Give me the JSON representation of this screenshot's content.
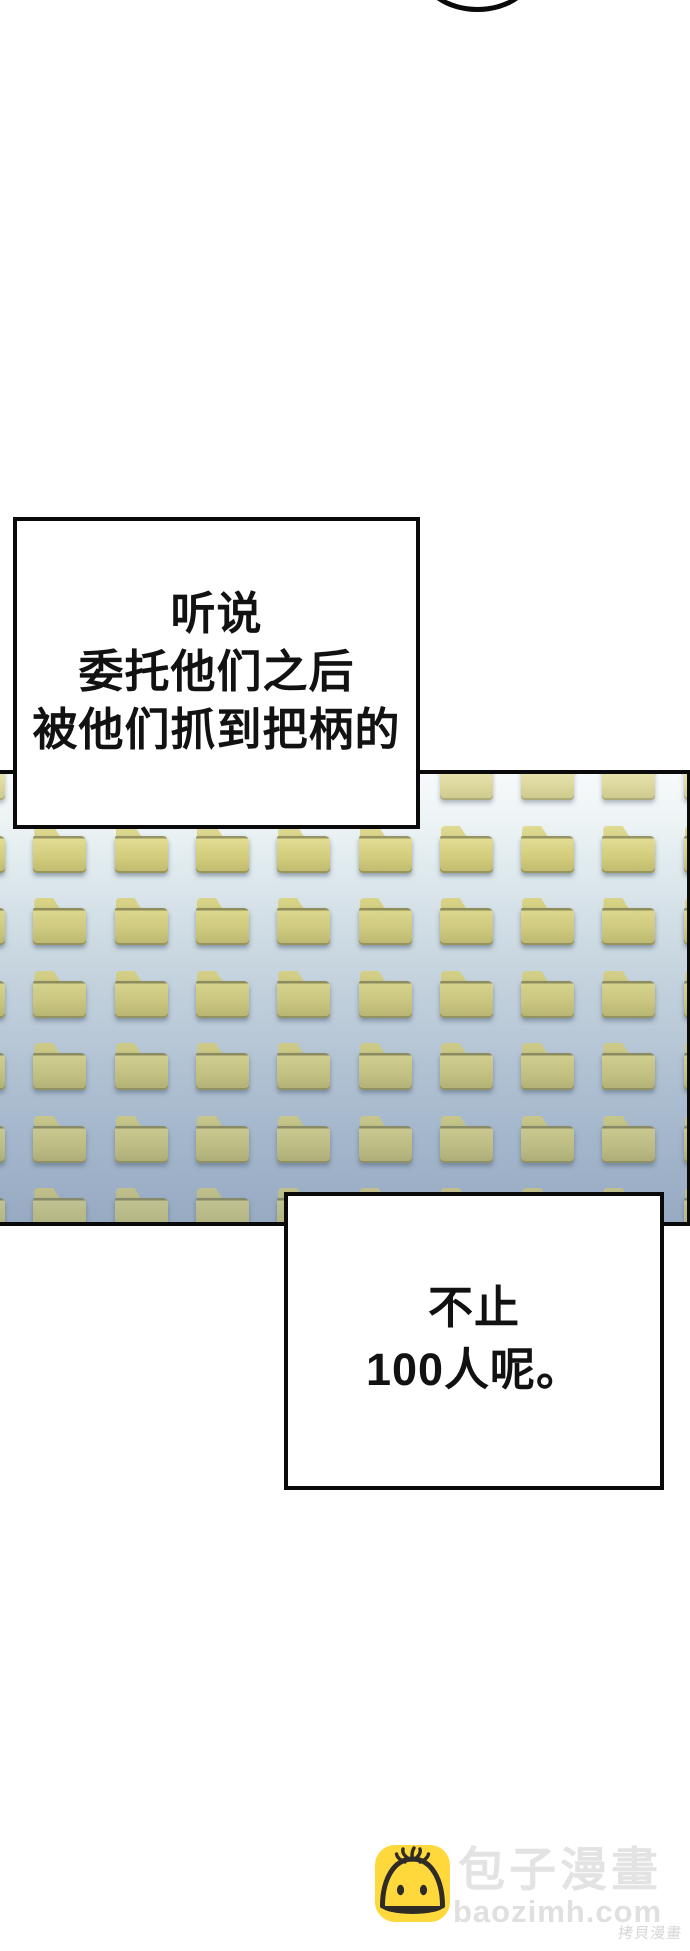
{
  "page": {
    "width": 690,
    "height": 1951,
    "background": "#ffffff"
  },
  "top_bubble_fragment": {
    "shape": "bottom arc of an off-screen speech bubble",
    "color": "#0a0a0a"
  },
  "bubbles": [
    {
      "id": "bubble-1",
      "lines": [
        "听说",
        "委托他们之后",
        "被他们抓到把柄的"
      ]
    },
    {
      "id": "bubble-2",
      "lines": [
        "不止",
        "100人呢。"
      ]
    }
  ],
  "panel": {
    "description": "screen panel tiled with identical yellow folder icons",
    "border_color": "#0a0a0a",
    "background_top": "#f3f8f8",
    "background_bottom": "#a9bcd2",
    "folder": {
      "body_color": "#d3cd7d",
      "body_light": "#dfda8c",
      "body_dark": "#c0ba6e",
      "tab_color": "#d6d07f",
      "edge_color": "#8f8d58"
    },
    "grid": {
      "rows": 7,
      "cols": 10,
      "origin_x": -46,
      "origin_y": -21,
      "pitch_x": 81.3,
      "pitch_y": 72.5,
      "icon_width": 53,
      "icon_height": 48
    }
  },
  "watermark": {
    "icon": "baozi-bun-icon",
    "icon_bg": "#ffd93c",
    "site_name": "包子漫畫",
    "site_url": "baozimh.com",
    "corner_text": "拷貝漫畫",
    "text_color": "#e3e3e3"
  }
}
